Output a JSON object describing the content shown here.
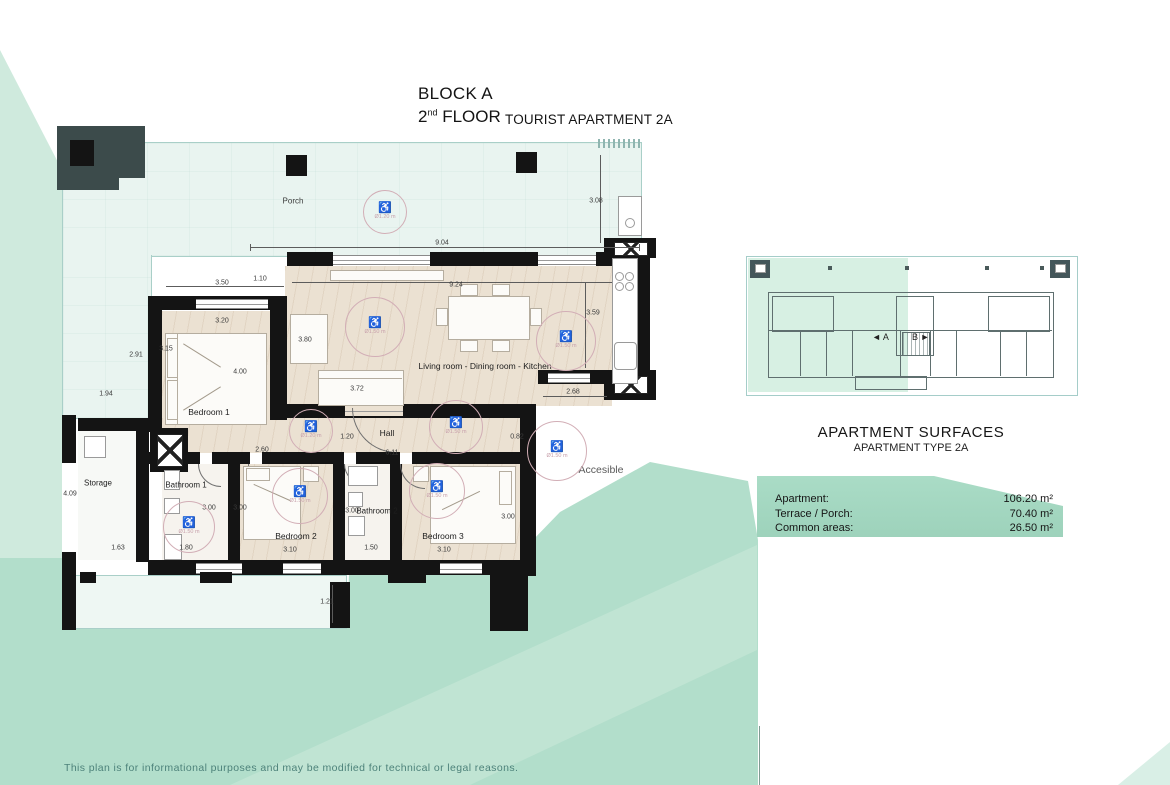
{
  "title": {
    "block": "BLOCK A",
    "floor_num": "2",
    "floor_sup": "nd",
    "floor_word": " FLOOR",
    "apartment": "TOURIST APARTMENT 2A"
  },
  "plan": {
    "rooms": {
      "porch": "Porch",
      "bedroom1": "Bedroom 1",
      "living": "Living room - Dining room - Kitchen",
      "hall": "Hall",
      "storage": "Storage",
      "bathroom1": "Bathroom 1",
      "bedroom2": "Bedroom 2",
      "bathroom2": "Bathroom 2",
      "bedroom3": "Bedroom 3",
      "accessible": "Accesible"
    },
    "dimensions": [
      {
        "text": "3.08",
        "x": 596,
        "y": 201
      },
      {
        "text": "9.04",
        "x": 442,
        "y": 243
      },
      {
        "text": "1.10",
        "x": 260,
        "y": 279
      },
      {
        "text": "3.50",
        "x": 222,
        "y": 283
      },
      {
        "text": "3.20",
        "x": 222,
        "y": 321
      },
      {
        "text": "2.91",
        "x": 136,
        "y": 355
      },
      {
        "text": "3.15",
        "x": 166,
        "y": 349
      },
      {
        "text": "1.94",
        "x": 106,
        "y": 394
      },
      {
        "text": "3.80",
        "x": 305,
        "y": 340
      },
      {
        "text": "9.24",
        "x": 456,
        "y": 285
      },
      {
        "text": "3.59",
        "x": 593,
        "y": 313
      },
      {
        "text": "4.00",
        "x": 240,
        "y": 372
      },
      {
        "text": "3.72",
        "x": 357,
        "y": 389
      },
      {
        "text": "1.20",
        "x": 347,
        "y": 437
      },
      {
        "text": "6.11",
        "x": 392,
        "y": 453
      },
      {
        "text": "2.60",
        "x": 262,
        "y": 450
      },
      {
        "text": "0.82",
        "x": 517,
        "y": 437
      },
      {
        "text": "2.68",
        "x": 573,
        "y": 392
      },
      {
        "text": "4.09",
        "x": 70,
        "y": 494
      },
      {
        "text": "1.63",
        "x": 118,
        "y": 548
      },
      {
        "text": "1.80",
        "x": 186,
        "y": 548
      },
      {
        "text": "3.00",
        "x": 209,
        "y": 508
      },
      {
        "text": "3.00",
        "x": 240,
        "y": 508
      },
      {
        "text": "3.10",
        "x": 290,
        "y": 550
      },
      {
        "text": "3.00",
        "x": 352,
        "y": 511
      },
      {
        "text": "1.50",
        "x": 371,
        "y": 548
      },
      {
        "text": "3.10",
        "x": 444,
        "y": 550
      },
      {
        "text": "3.00",
        "x": 508,
        "y": 517
      },
      {
        "text": "1.21",
        "x": 327,
        "y": 602
      }
    ],
    "accessibility_circles": [
      {
        "label": "Ø1.20 m",
        "x": 385,
        "y": 212,
        "r": 21
      },
      {
        "label": "Ø1.50 m",
        "x": 375,
        "y": 327,
        "r": 29
      },
      {
        "label": "Ø1.50 m",
        "x": 566,
        "y": 341,
        "r": 29
      },
      {
        "label": "Ø1.20 m",
        "x": 311,
        "y": 431,
        "r": 21
      },
      {
        "label": "Ø1.50 m",
        "x": 456,
        "y": 427,
        "r": 26
      },
      {
        "label": "Ø1.50 m",
        "x": 557,
        "y": 451,
        "r": 29
      },
      {
        "label": "Ø1.50 m",
        "x": 189,
        "y": 527,
        "r": 25
      },
      {
        "label": "Ø1.50 m",
        "x": 300,
        "y": 496,
        "r": 27
      },
      {
        "label": "Ø1.50 m",
        "x": 437,
        "y": 491,
        "r": 27
      }
    ],
    "wheelchair_glyph": "♿"
  },
  "key_plan": {
    "label_a": "◄ A",
    "label_b": "B ►"
  },
  "surfaces": {
    "title": "APARTMENT SURFACES",
    "subtitle": "APARTMENT TYPE 2A",
    "rows": [
      {
        "label": "Apartment:",
        "value": "106.20 m²"
      },
      {
        "label": "Terrace / Porch:",
        "value": "70.40 m²"
      },
      {
        "label": "Common areas:",
        "value": "26.50 m²"
      }
    ]
  },
  "disclaimer": "This plan is for informational purposes and may be modified for technical or legal reasons.",
  "colors": {
    "mint_light": "#cfeadd",
    "mint_medium": "#b2decb",
    "mint_band": "#c0e4d3",
    "table_green": "#a3d6bf",
    "wall_black": "#141414",
    "accessibility_pink": "#c7a0ab",
    "disclaimer_teal": "#4d827a"
  }
}
